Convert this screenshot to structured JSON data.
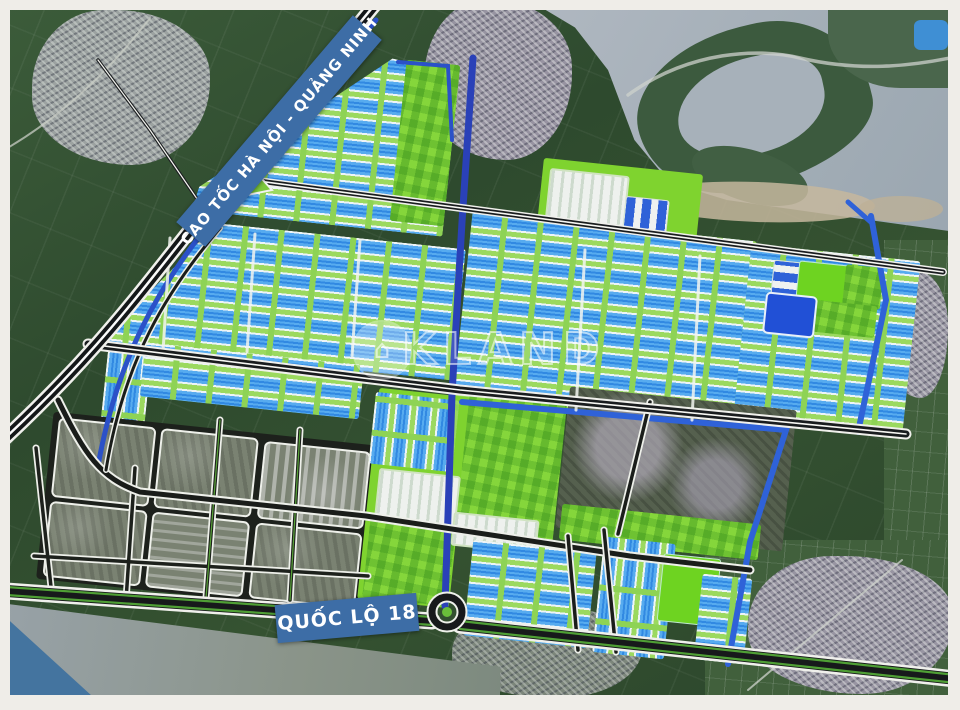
{
  "map": {
    "labels": {
      "expressway": "CAO TỐC HÀ NỘI - QUẢNG NINH",
      "national_road": "QUỐC LỘ 18"
    },
    "watermark": {
      "text": "KLAND",
      "logo_glyph": "⌂"
    },
    "colors": {
      "banner_blue": "#3d6da6",
      "park_green": "#86cf44",
      "lime_bright": "#6ed321",
      "factory_blue": "#57abef",
      "canal_blue": "#2b51c8",
      "pond_blue": "#2150d6",
      "road_black": "#17191b",
      "river_gray": "#a9b2bb",
      "sand": "#c5b79d",
      "water_wedge": "#44749f"
    }
  }
}
